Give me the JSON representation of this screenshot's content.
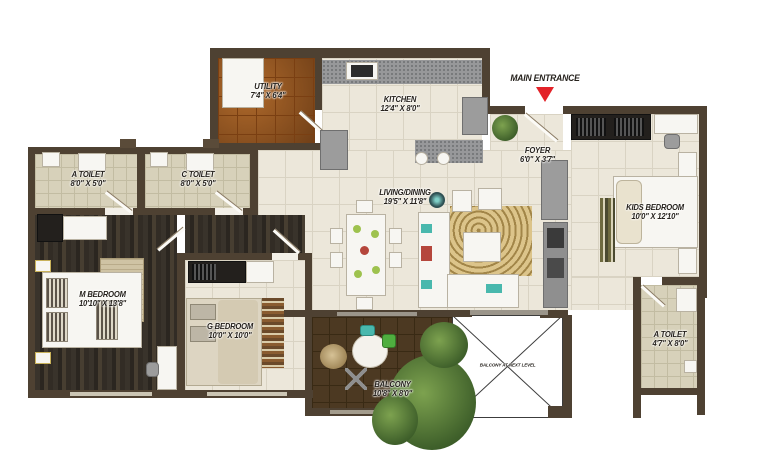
{
  "entrance": {
    "label": "MAIN ENTRANCE"
  },
  "rooms": {
    "utility": {
      "name": "UTILITY",
      "dims": "7'4\" X 6'4\""
    },
    "kitchen": {
      "name": "KITCHEN",
      "dims": "12'4\" X 8'0\""
    },
    "foyer": {
      "name": "FOYER",
      "dims": "6'0\" X 3'7\""
    },
    "a_toilet_left": {
      "name": "A TOILET",
      "dims": "8'0\" X 5'0\""
    },
    "c_toilet": {
      "name": "C TOILET",
      "dims": "8'0\" X 5'0\""
    },
    "living_dining": {
      "name": "LIVING/DINING",
      "dims": "19'5\" X 11'8\""
    },
    "kids_bedroom": {
      "name": "KIDS BEDROOM",
      "dims": "10'0\" X 12'10\""
    },
    "m_bedroom": {
      "name": "M BEDROOM",
      "dims": "10'10\" X 13'8\""
    },
    "g_bedroom": {
      "name": "G BEDROOM",
      "dims": "10'0\" X 10'0\""
    },
    "balcony": {
      "name": "BALCONY",
      "dims": "10'8\" X 8'0\""
    },
    "a_toilet_right": {
      "name": "A TOILET",
      "dims": "4'7\" X 8'0\""
    },
    "balcony_next_level": {
      "name": "BALCONY AT NEXT LEVEL"
    }
  },
  "colors": {
    "wall": "#4e4132",
    "floor_cream": "#ece7da",
    "floor_toilet": "#d7d1ba",
    "floor_utility": "#95541f",
    "floor_wood_dark": "#39332b",
    "floor_balcony": "#4c3922",
    "entrance_arrow": "#e32228",
    "carpet_gold": "#c9ae70"
  }
}
